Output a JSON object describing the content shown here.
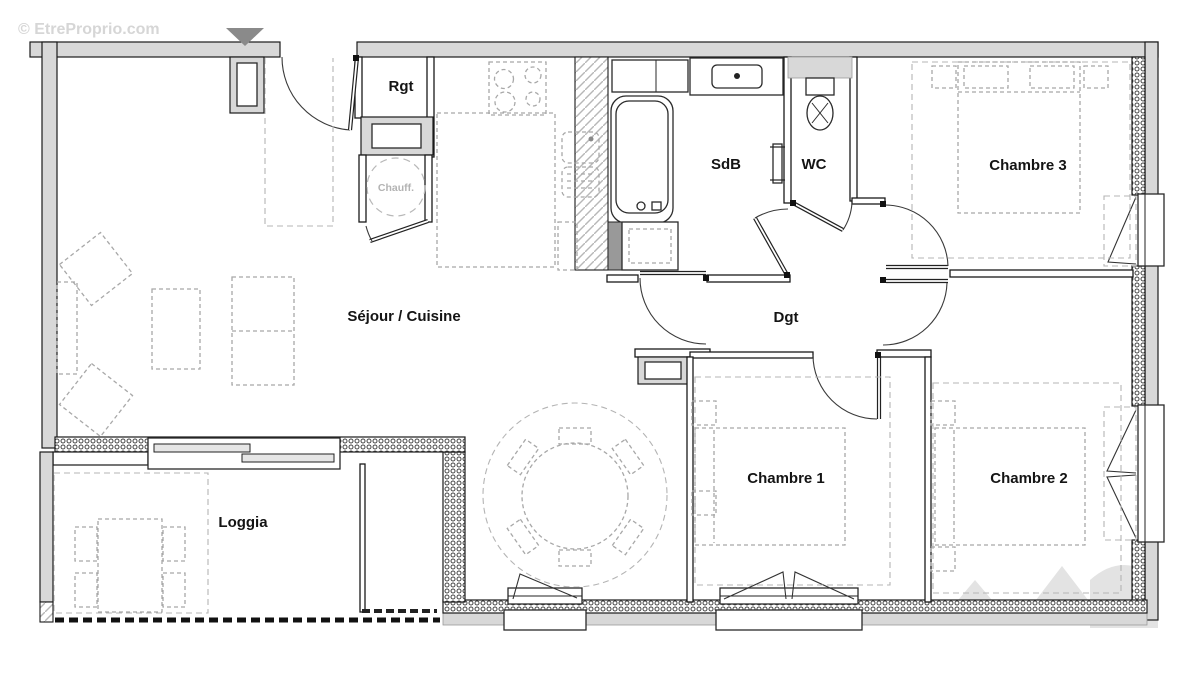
{
  "watermark": {
    "top_left": "© EtreProprio.com"
  },
  "rooms": {
    "entry_storage": "Rgt",
    "water_heater": "Chauff.",
    "bathroom": "SdB",
    "toilet": "WC",
    "bedroom3": "Chambre 3",
    "living_kitchen": "Séjour / Cuisine",
    "hallway": "Dgt",
    "bedroom1": "Chambre 1",
    "bedroom2": "Chambre 2",
    "loggia": "Loggia"
  },
  "colors": {
    "wall_gray": "#d8d8d8",
    "line_black": "#1a1a1a",
    "furniture_gray": "#a8a8a8",
    "watermark_gray": "#d6d6d6",
    "entrance_marker": "#8a8a8a"
  }
}
